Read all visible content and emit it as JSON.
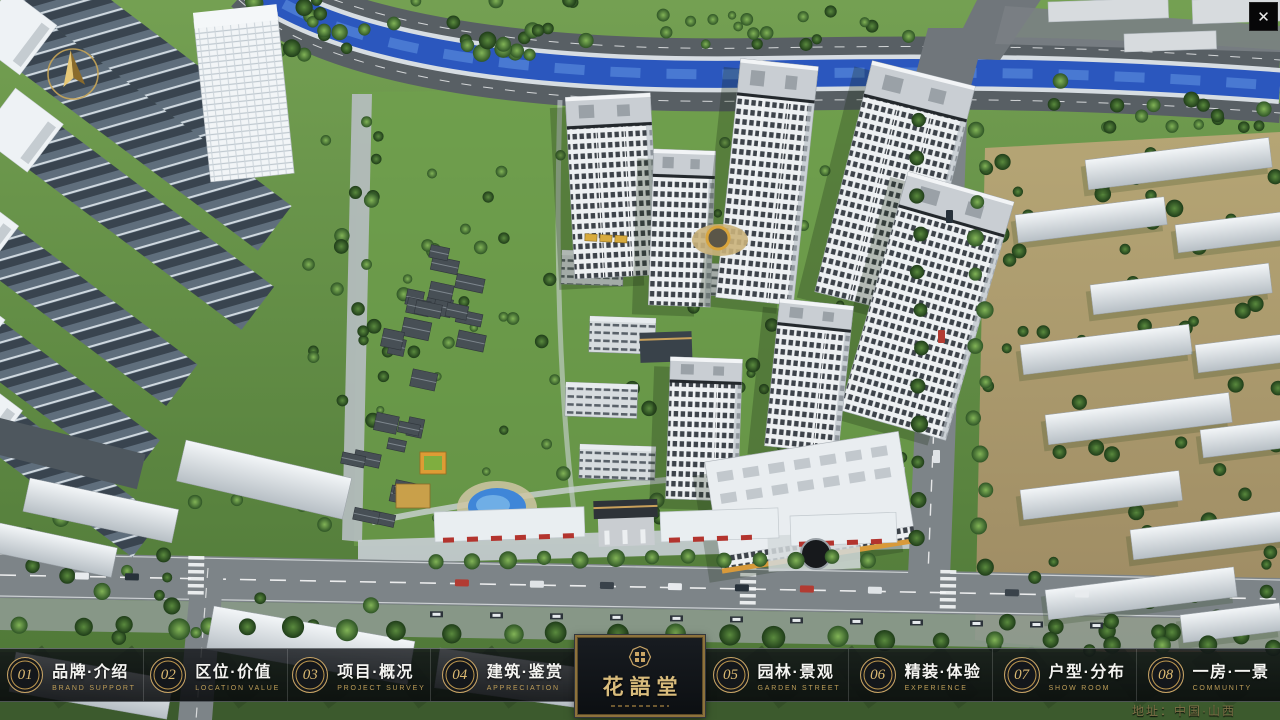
{
  "window": {
    "close_label": "✕"
  },
  "nav": {
    "items": [
      {
        "num": "01",
        "zh": "品牌·介绍",
        "en": "BRAND SUPPORT"
      },
      {
        "num": "02",
        "zh": "区位·价值",
        "en": "LOCATION VALUE"
      },
      {
        "num": "03",
        "zh": "项目·概况",
        "en": "PROJECT SURVEY"
      },
      {
        "num": "04",
        "zh": "建筑·鉴赏",
        "en": "APPRECIATION"
      },
      {
        "num": "05",
        "zh": "园林·景观",
        "en": "GARDEN STREET"
      },
      {
        "num": "06",
        "zh": "精装·体验",
        "en": "EXPERIENCE"
      },
      {
        "num": "07",
        "zh": "户型·分布",
        "en": "SHOW ROOM"
      },
      {
        "num": "08",
        "zh": "一房·一景",
        "en": "COMMUNITY"
      }
    ]
  },
  "logo": {
    "name": "花語堂"
  },
  "footer": {
    "address": "地址：中国·山西"
  },
  "colors": {
    "gold": "#c9a566",
    "bar_bg": "#0c0f12",
    "water": "#2b57be",
    "grass": "#5d8a40"
  }
}
